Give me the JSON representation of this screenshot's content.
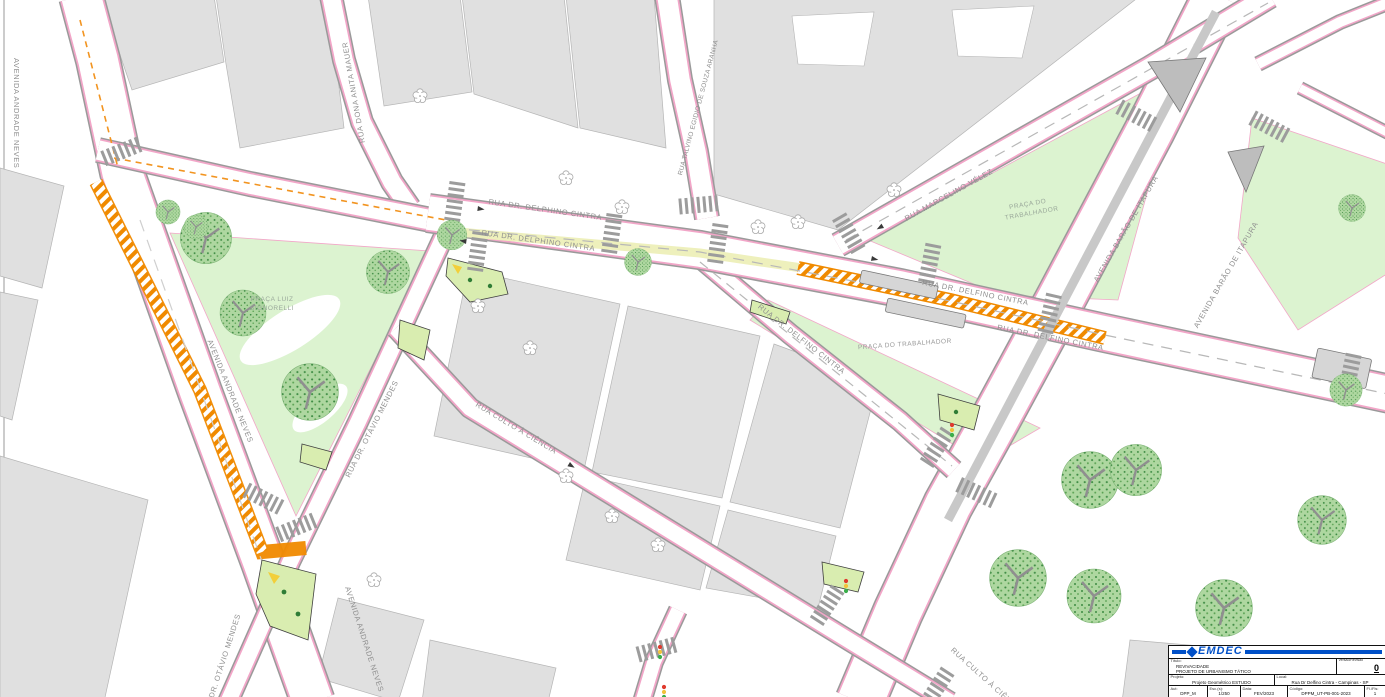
{
  "map": {
    "streets": {
      "andrade_neves": "AVENIDA ANDRADE NEVES",
      "otavio_mendes": "RUA DR. OTÁVIO MENDES",
      "delphino_cintra": "RUA DR. DELPHINO CINTRA",
      "delfino_cintra": "RUA DR. DELFINO CINTRA",
      "marcelino_velez": "RUA MARCELINO VÉLEZ",
      "barao_itapura": "AVENIDA BARÃO DE ITAPURA",
      "anita_mauer": "RUA DONA ANITA MAUER",
      "talvino": "RUA TALVINO EGIDIO DE SOUZA ARANHA",
      "culto_ciencia": "RUA CULTO À CIÊNCIA"
    },
    "plazas": {
      "signorelli_l1": "PRAÇA LUIZ",
      "signorelli_l2": "SIGNORELLI",
      "trabalhador_l1": "PRAÇA DO",
      "trabalhador_l2": "TRABALHADOR",
      "trabalhador_single": "PRAÇA DO TRABALHADOR"
    }
  },
  "title_block": {
    "logo": "EMDEC",
    "title_label": "Título:",
    "title_line1": "REVIVACIDADE",
    "title_line2": "PROJETO DE URBANISMO TÁTICO",
    "version_label": "Versão/Revisão",
    "version_value": "0",
    "project_label": "Projeto:",
    "project_value": "Projeto Geométrico ESTUDO",
    "local_label": "Local:",
    "local_value": "Rua Dr Delfino Cintra - Campinas - SP",
    "author_label": "Aut:",
    "author_value": "DPP_M",
    "scale_label": "Esc.(s):",
    "scale_value": "1/250",
    "date_label": "Data:",
    "date_value": "FEV/2023",
    "code_label": "Código:",
    "code_value": "DPPM_UT-PB-001-2023",
    "sheet_label": "Fl./Fls:",
    "sheet_value": "1"
  },
  "colors": {
    "emdec_blue": "#0050c8",
    "hatch_orange": "#f08a00",
    "plaza_green": "#dcf3d0",
    "building_gray": "#e0e0e0",
    "curb_pink": "#f2a6c8",
    "tree_green": "#aed7a0"
  }
}
